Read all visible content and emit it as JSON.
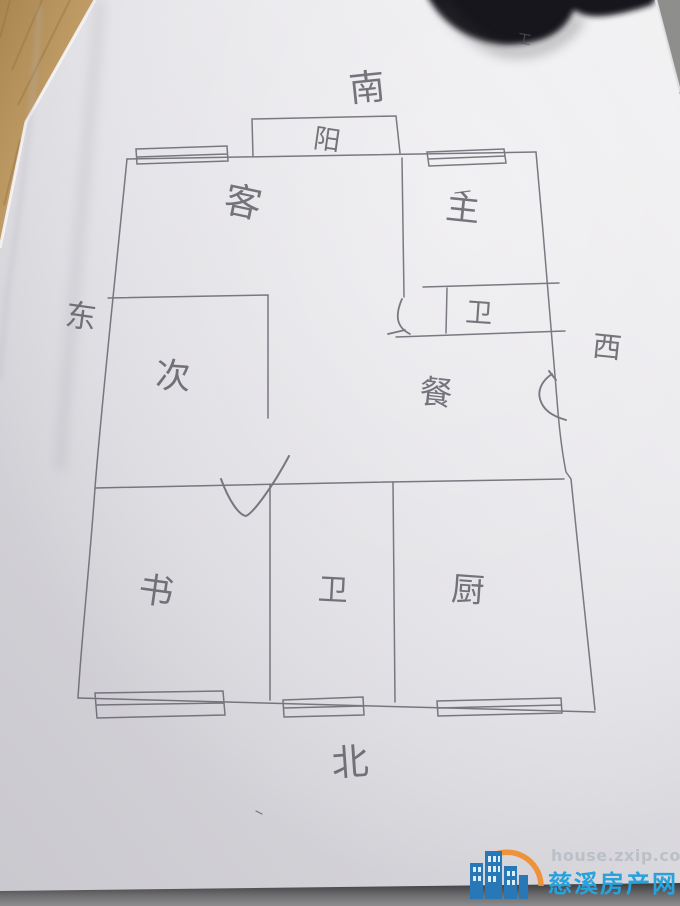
{
  "compass": {
    "south": "南",
    "north": "北",
    "east": "东",
    "west": "西"
  },
  "rooms": {
    "balcony": "阳",
    "living": "客",
    "master": "主",
    "bath_upper": "卫",
    "second": "次",
    "dining": "餐",
    "study": "书",
    "bath_lower": "卫",
    "kitchen": "厨"
  },
  "marks": {
    "scribble": "工"
  },
  "watermark": {
    "site": "house.zxip.com",
    "name": "慈溪房产网"
  },
  "colors": {
    "pencil": "#5f5f66",
    "paper_light": "#f0eff2",
    "paper_dark": "#d7d6db",
    "wood": "#b3905c",
    "dark_object": "#1a1a1c",
    "watermark_blue": "#29a2dc",
    "watermark_gray": "#b9bfc7",
    "logo_orange": "#ef8f33"
  }
}
